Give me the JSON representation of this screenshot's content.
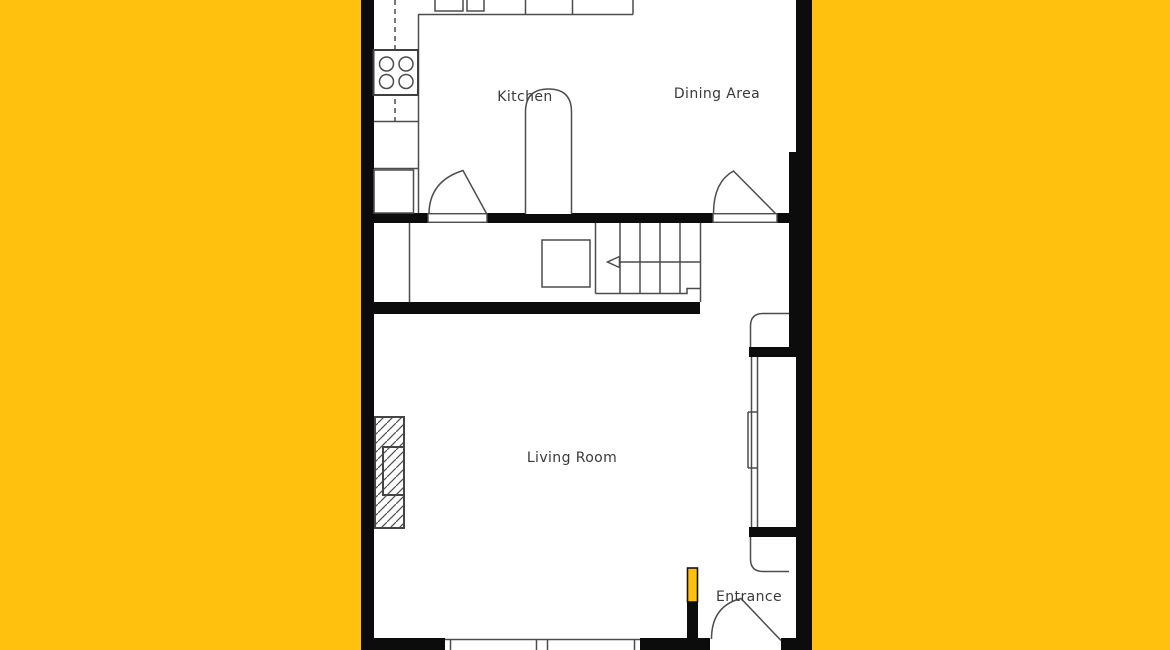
{
  "plan": {
    "type": "floor-plan",
    "rooms": {
      "kitchen": {
        "label": "Kitchen"
      },
      "dining": {
        "label": "Dining Area"
      },
      "living": {
        "label": "Living Room"
      },
      "entrance": {
        "label": "Entrance"
      }
    },
    "symbols": {
      "stairs_arrow": "left-arrow",
      "doors": "quarter-circle-door-swing",
      "fireplace": "diagonal-hatched-rectangle",
      "stove": "four-burner-cooktop",
      "window_bay": "double-line-window-with-curved-returns",
      "highlighted_wall": "yellow-wall-stub-at-entrance"
    },
    "colors": {
      "background": "#ffc10d",
      "floor": "#ffffff",
      "wall": "#0c0c0c",
      "line": "#4c4c4c",
      "text": "#3a3a3a",
      "highlight": "#ffc10d"
    }
  }
}
